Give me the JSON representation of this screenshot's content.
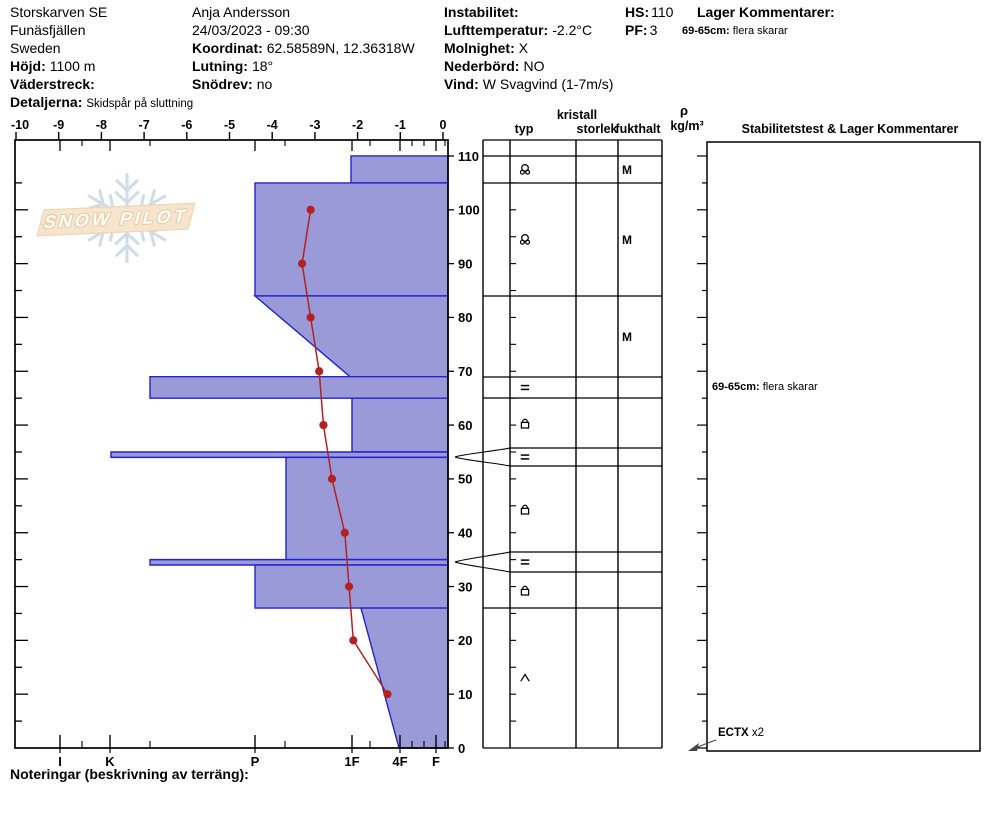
{
  "title_block": {
    "col1": {
      "line1": "Storskarven SE",
      "line2": "Funäsfjällen",
      "line3": "Sweden",
      "hojd_label": "Höjd:",
      "hojd_value": "1100 m",
      "vaderstreck_label": "Väderstreck:",
      "vaderstreck_value": "",
      "detaljerna_label": "Detaljerna:",
      "detaljerna_value": "Skidspår på sluttning"
    },
    "col2": {
      "observer": "Anja Andersson",
      "datetime": "24/03/2023 - 09:30",
      "koordinat_label": "Koordinat:",
      "koordinat_value": "62.58589N, 12.36318W",
      "lutning_label": "Lutning:",
      "lutning_value": "18°",
      "snodrev_label": "Snödrev:",
      "snodrev_value": "no"
    },
    "col3": {
      "instabilitet_label": "Instabilitet:",
      "instabilitet_value": "",
      "lufttemperatur_label": "Lufttemperatur:",
      "lufttemperatur_value": "-2.2°C",
      "molnighet_label": "Molnighet:",
      "molnighet_value": "X",
      "nederbord_label": "Nederbörd:",
      "nederbord_value": "NO",
      "vind_label": "Vind:",
      "vind_value": "W Svagvind (1-7m/s)"
    },
    "col4": {
      "hs_label": "HS:",
      "hs_value": "110",
      "pf_label": "PF:",
      "pf_value": "3"
    },
    "col5": {
      "lager_label": "Lager Kommentarer:",
      "comment_range": "69-65cm:",
      "comment_text": "flera skarar"
    }
  },
  "logo": {
    "text": "SNOW PILOT"
  },
  "table_headers": {
    "kristall": "kristall",
    "typ": "typ",
    "storlek": "storlek",
    "fukthalt": "fukthalt",
    "rho": "ρ",
    "rho_unit": "kg/m³",
    "stability": "Stabilitetstest & Lager Kommentarer"
  },
  "comments_panel": {
    "entry_range": "69-65cm:",
    "entry_text": "flera skarar"
  },
  "stability_test": {
    "label": "ECTX",
    "count": "x2"
  },
  "footer": {
    "noteringar": "Noteringar (beskrivning av terräng):"
  },
  "icons": {
    "snowflake": "snowflake-icon",
    "grain_rimed_precipitation": "circle with two small circles",
    "grain_crust": "=",
    "grain_rounded_facets": "square with arc top",
    "grain_depth_hoar": "∧",
    "ectx_arrow": "arrow pointing to profile bottom"
  },
  "colors": {
    "layer_fill": "#9a9ad8",
    "layer_stroke": "#2323cc",
    "temp_line": "#b22222",
    "axis": "#000000",
    "logo_flake": "#cfdde9",
    "logo_banner_bg": "#f7e4cd",
    "logo_banner_border": "#eed3b2"
  },
  "chart_data": {
    "type": "bar",
    "subtype": "snow-profile-horizontal",
    "title": "SnowPilot snow pit profile",
    "depth_axis": {
      "unit": "cm",
      "min": 0,
      "max": 110,
      "tick_step": 10,
      "minor_step": 5
    },
    "temperature_axis": {
      "unit": "°C",
      "min": -10,
      "max": 0,
      "tick_step": 1
    },
    "hardness_axis": {
      "labels": [
        "I",
        "K",
        "P",
        "1F",
        "4F",
        "F"
      ]
    },
    "snow_height_cm": 110,
    "layers": [
      {
        "depth_top": 110,
        "depth_bottom": 105,
        "hardness": "1F",
        "grain_type": "rimed-precipitation",
        "moisture": "M"
      },
      {
        "depth_top": 105,
        "depth_bottom": 84,
        "hardness": "P",
        "grain_type": "rimed-precipitation",
        "moisture": "M"
      },
      {
        "depth_top": 84,
        "depth_bottom": 69,
        "hardness": "P to 1F",
        "grain_type": "",
        "moisture": "M"
      },
      {
        "depth_top": 69,
        "depth_bottom": 65,
        "hardness": "K-P",
        "grain_type": "crust",
        "moisture": "",
        "comment": "flera skarar"
      },
      {
        "depth_top": 65,
        "depth_bottom": 55,
        "hardness": "1F",
        "grain_type": "rounded-facets",
        "moisture": ""
      },
      {
        "depth_top": 55,
        "depth_bottom": 54,
        "hardness": "K",
        "grain_type": "crust",
        "moisture": "",
        "thin": true
      },
      {
        "depth_top": 54,
        "depth_bottom": 35,
        "hardness": "P-",
        "grain_type": "rounded-facets",
        "moisture": ""
      },
      {
        "depth_top": 35,
        "depth_bottom": 34,
        "hardness": "K-P",
        "grain_type": "crust",
        "moisture": "",
        "thin": true
      },
      {
        "depth_top": 34,
        "depth_bottom": 26,
        "hardness": "P",
        "grain_type": "rounded-facets",
        "moisture": ""
      },
      {
        "depth_top": 26,
        "depth_bottom": 0,
        "hardness": "1F to 4F",
        "grain_type": "depth-hoar",
        "moisture": ""
      }
    ],
    "temperature_profile": {
      "depths_cm": [
        100,
        90,
        80,
        70,
        60,
        50,
        40,
        30,
        20,
        10
      ],
      "temps_c": [
        -3.1,
        -3.3,
        -3.1,
        -2.9,
        -2.8,
        -2.6,
        -2.3,
        -2.2,
        -2.1,
        -1.3
      ]
    },
    "layout": {
      "frame": {
        "left": 15,
        "top": 140,
        "right": 448,
        "bottom": 748
      },
      "px_per_cm": 5.382,
      "temp_x0": 443,
      "px_per_deg": 42.7,
      "hardness_x_px": {
        "I": 60,
        "K": 110,
        "P": 255,
        "1F": 352,
        "4F": 400,
        "F": 436,
        "K-P": 150,
        "P-": 286,
        "right": 448
      },
      "hardness_minor_ticks_px": [
        82,
        150,
        285,
        370,
        412,
        424,
        445
      ],
      "layer_left_x_px": [
        351,
        255,
        [
          255,
          350
        ],
        150,
        352,
        111,
        286,
        150,
        255,
        [
          361,
          399
        ]
      ],
      "table": {
        "left": 483,
        "cols": [
          510,
          576,
          618
        ],
        "right": 662,
        "row_lines": [
          140,
          156,
          183,
          296,
          377,
          398,
          448,
          466,
          552,
          572,
          608,
          748
        ],
        "pinch_rows": [
          [
            448,
            466
          ],
          [
            552,
            572
          ]
        ],
        "symbol_x": 525,
        "moisture_x": 622,
        "rows": [
          {
            "y1": 156,
            "y2": 183,
            "grain": "rimed-precipitation",
            "moisture": "M"
          },
          {
            "y1": 183,
            "y2": 296,
            "grain": "rimed-precipitation",
            "moisture": "M"
          },
          {
            "y1": 296,
            "y2": 377,
            "grain": "",
            "moisture": "M"
          },
          {
            "y1": 377,
            "y2": 398,
            "grain": "crust",
            "moisture": ""
          },
          {
            "y1": 398,
            "y2": 448,
            "grain": "rounded-facets",
            "moisture": ""
          },
          {
            "y1": 448,
            "y2": 466,
            "grain": "crust",
            "moisture": ""
          },
          {
            "y1": 466,
            "y2": 552,
            "grain": "rounded-facets",
            "moisture": ""
          },
          {
            "y1": 552,
            "y2": 572,
            "grain": "crust",
            "moisture": ""
          },
          {
            "y1": 572,
            "y2": 608,
            "grain": "rounded-facets",
            "moisture": ""
          },
          {
            "y1": 608,
            "y2": 748,
            "grain": "depth-hoar",
            "moisture": ""
          }
        ]
      },
      "comments_box": {
        "left": 707,
        "top": 142,
        "right": 980,
        "bottom": 751
      },
      "comment_y": 388,
      "ectx": {
        "text_x": 718,
        "text_y": 728,
        "arrow_tip_x": 691,
        "arrow_tip_y": 749
      }
    }
  }
}
